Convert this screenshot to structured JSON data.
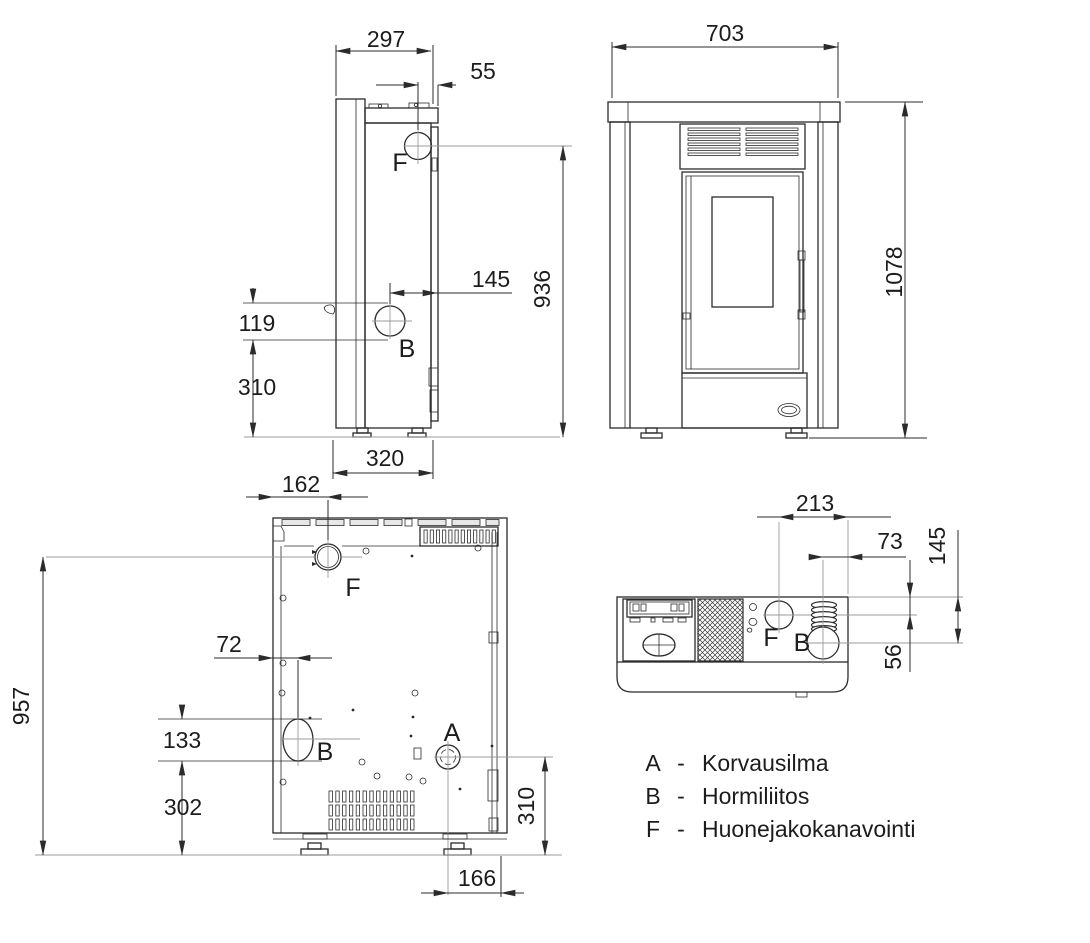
{
  "drawing": {
    "legend": {
      "items": [
        {
          "key": "A",
          "dash": "-",
          "label": "Korvausilma"
        },
        {
          "key": "B",
          "dash": "-",
          "label": "Hormiliitos"
        },
        {
          "key": "F",
          "dash": "-",
          "label": "Huonejakokanavointi"
        }
      ]
    },
    "side_view": {
      "depth_top": "297",
      "f_offset": "55",
      "b_offset": "145",
      "f_height": "936",
      "b_span": "119",
      "b_height": "310",
      "depth_bottom": "320",
      "f_label": "F",
      "b_label": "B"
    },
    "front_view": {
      "width": "703",
      "height": "1078"
    },
    "back_view": {
      "f_offset": "162",
      "b_offset": "72",
      "f_height": "957",
      "b_span": "133",
      "b_height": "302",
      "a_height": "310",
      "a_offset": "166",
      "f_label": "F",
      "b_label": "B",
      "a_label": "A"
    },
    "top_view": {
      "f_offset": "213",
      "b_offset": "73",
      "b_depth": "145",
      "f_depth": "56",
      "f_label": "F",
      "b_label": "B"
    }
  }
}
